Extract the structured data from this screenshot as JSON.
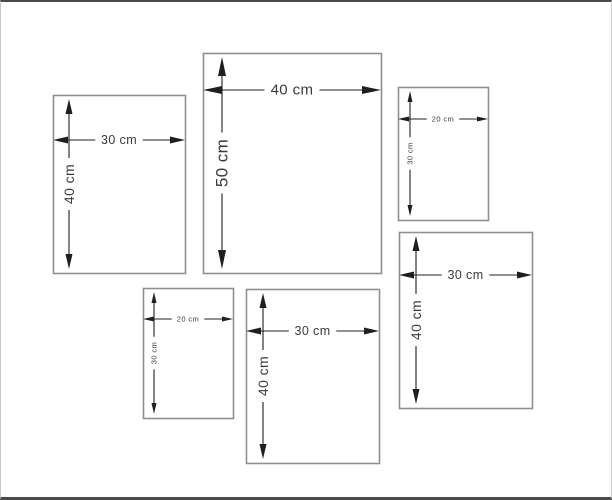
{
  "frame": {
    "background": "#ffffff",
    "top_bar_color": "#4a4a4a",
    "bottom_bar_color": "#4a4a4a",
    "side_border_color": "#c9c9c9"
  },
  "style": {
    "panel_border_color": "#8f8f8f",
    "dimension_color": "#1f1f1f",
    "label_color": "#3a3a3a"
  },
  "sizes": {
    "xl": {
      "font": 15,
      "fontV": 17,
      "arrow_len": 19,
      "arrow_hw": 4
    },
    "large": {
      "font": 12.5,
      "fontV": 14,
      "arrow_len": 15,
      "arrow_hw": 3.5
    },
    "small": {
      "font": 7.5,
      "fontV": 7.5,
      "arrow_len": 11,
      "arrow_hw": 2.5
    }
  },
  "panels": [
    {
      "name": "panel-30x40-top-left",
      "width_cm": 30,
      "height_cm": 40,
      "width_label": "30 cm",
      "height_label": "40 cm",
      "size": "large",
      "x": 52,
      "y": 93,
      "w": 132,
      "h": 178,
      "dim_h_y": 138,
      "dim_v_x": 68
    },
    {
      "name": "panel-40x50-top-center",
      "width_cm": 40,
      "height_cm": 50,
      "width_label": "40 cm",
      "height_label": "50 cm",
      "size": "xl",
      "x": 202,
      "y": 51,
      "w": 178,
      "h": 220,
      "dim_h_y": 88,
      "dim_v_x": 221
    },
    {
      "name": "panel-20x30-top-right",
      "width_cm": 20,
      "height_cm": 30,
      "width_label": "20 cm",
      "height_label": "30 cm",
      "size": "small",
      "x": 397,
      "y": 85,
      "w": 90,
      "h": 133,
      "dim_h_y": 117,
      "dim_v_x": 409
    },
    {
      "name": "panel-30x40-right",
      "width_cm": 30,
      "height_cm": 40,
      "width_label": "30 cm",
      "height_label": "40 cm",
      "size": "large",
      "x": 398,
      "y": 230,
      "w": 133,
      "h": 176,
      "dim_h_y": 273,
      "dim_v_x": 415
    },
    {
      "name": "panel-20x30-bottom-left",
      "width_cm": 20,
      "height_cm": 30,
      "width_label": "20 cm",
      "height_label": "30 cm",
      "size": "small",
      "x": 142,
      "y": 286,
      "w": 90,
      "h": 130,
      "dim_h_y": 317,
      "dim_v_x": 153
    },
    {
      "name": "panel-30x40-bottom-center",
      "width_cm": 30,
      "height_cm": 40,
      "width_label": "30 cm",
      "height_label": "40 cm",
      "size": "large",
      "x": 245,
      "y": 287,
      "w": 133,
      "h": 174,
      "dim_h_y": 329,
      "dim_v_x": 262
    }
  ]
}
